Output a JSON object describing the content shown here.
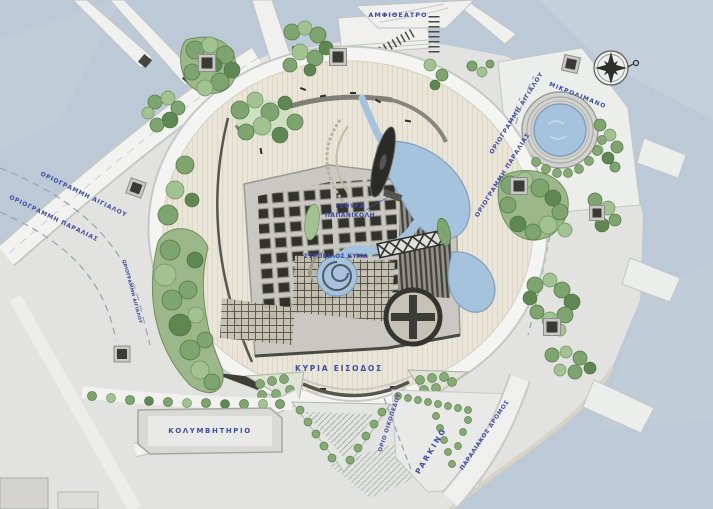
{
  "meta": {
    "kind": "architectural-site-plan",
    "style": "rendered master plan, top view"
  },
  "colors": {
    "water": "#bccad7",
    "water_light": "#cdd8e1",
    "land": "#e2e3e1",
    "plaza_paving": "#e9e5d8",
    "road": "#f2f3f1",
    "building_gray": "#c9c8c2",
    "module_dark": "#32322d",
    "tree_green": "#7ea46f",
    "pool_blue": "#a6c3dd",
    "label_blue": "#3d4ba3",
    "compass_dark": "#2e2e2a"
  },
  "labels": {
    "amphitheater": "ΑΜΦΙΘΕΑΤΡΟ",
    "shoreline_left": "ΟΡΙΟΓΡΑΜΜΗ ΑΙΓΙΑΛΟΥ",
    "beachline_left": "ΟΡΙΟΓΡΑΜΜΗ ΠΑΡΑΛΙΑΣ",
    "mikrolimano": "ΜΙΚΡΟΛΙΜΑΝΟ",
    "shoreline_right": "ΟΡΙΟΓΡΑΜΜΗ ΑΙΓΙΑΛΟΥ",
    "beachline_right": "ΟΡΙΟΓΡΑΜΜΗ ΠΑΡΑΛΙΑΣ",
    "shoreline_path": "ΟΡΙΟΓΡΑΜΜΗ ΑΙΓΙΑΛΟΥ",
    "bridge_1": "ΓΕΦΥΡΑ",
    "bridge_2": "ΠΑΠΑΝΙΚΟΛΗ",
    "vortex_wave": "ΣΤΡΟΒΙΛΟΣ ΚΥΜΑ",
    "main_entrance": "ΚΥΡΙΑ ΕΙΣΟΔΟΣ",
    "swimming_pool": "ΚΟΛΥΜΒΗΤΗΡΙΟ",
    "parking": "PARKING",
    "plot_boundary": "ΟΡΙΟ ΟΙΚΟΠΕΔΟΥ",
    "coastal_road": "ΠΑΡΑΛΙΑΚΟΣ ΔΡΟΜΟΣ"
  }
}
